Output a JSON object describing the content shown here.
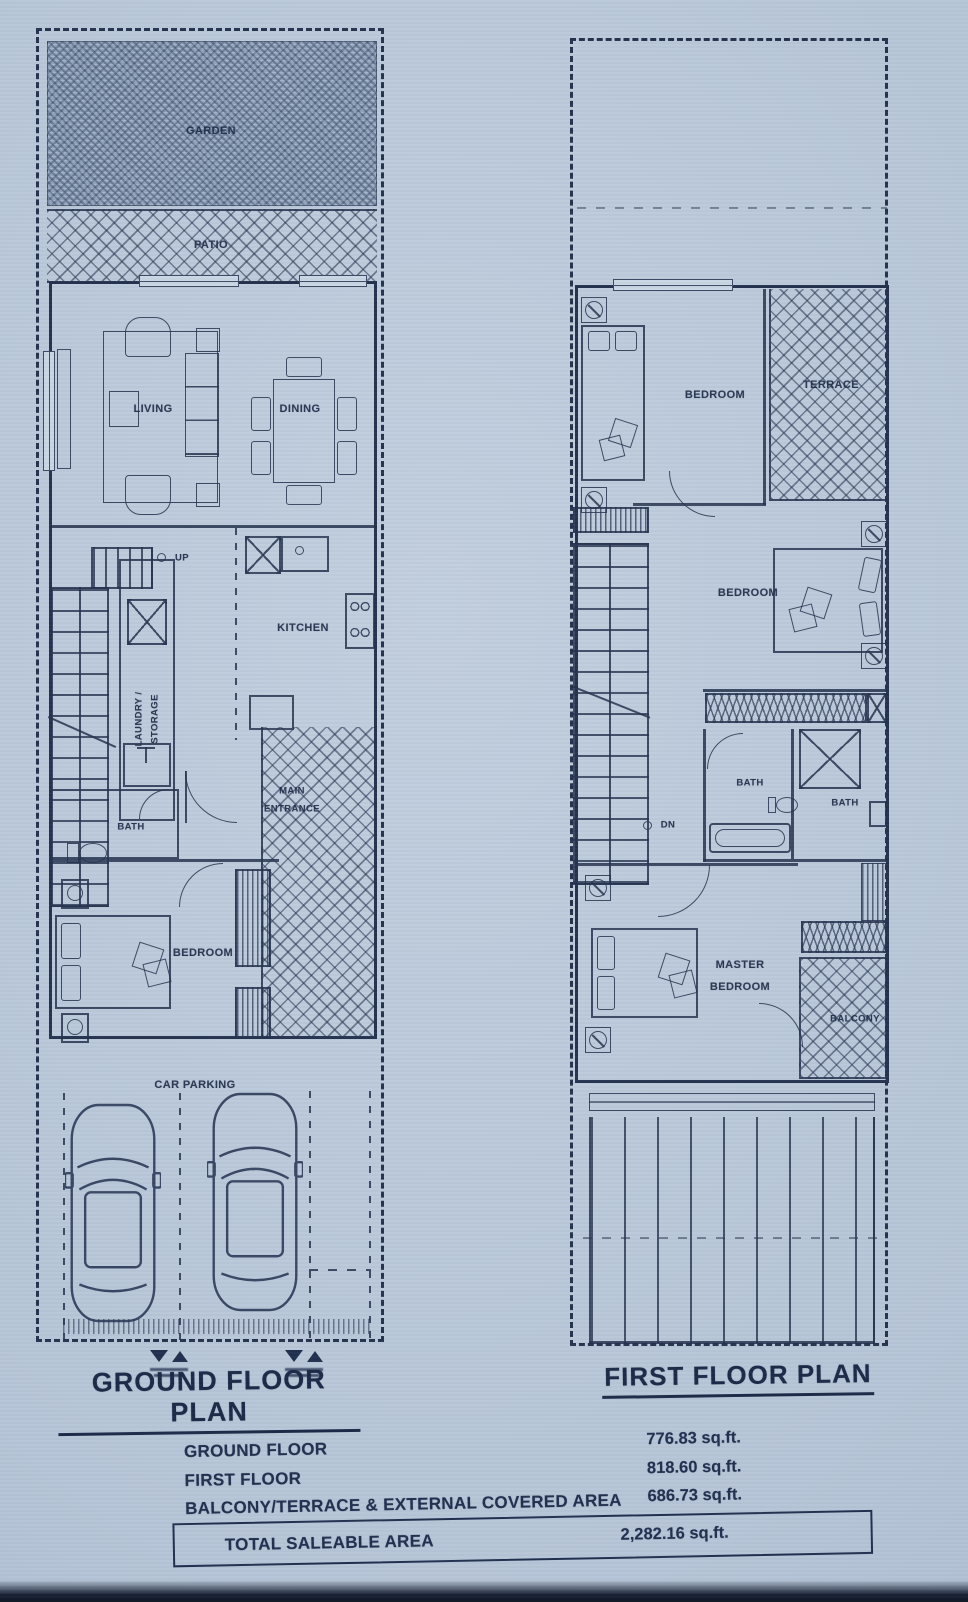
{
  "photo": {
    "paper_color": "#b6c5d7",
    "ink_color": "#26334f"
  },
  "ground_floor": {
    "title": "GROUND FLOOR PLAN",
    "labels": {
      "garden": "GARDEN",
      "patio": "PATIO",
      "living": "LIVING",
      "dining": "DINING",
      "up": "UP",
      "kitchen": "KITCHEN",
      "laundry_line1": "LAUNDRY /",
      "laundry_line2": "STORAGE",
      "bath": "BATH",
      "main_entrance_line1": "MAIN",
      "main_entrance_line2": "ENTRANCE",
      "bedroom": "BEDROOM",
      "car_parking": "CAR PARKING"
    }
  },
  "first_floor": {
    "title": "FIRST FLOOR PLAN",
    "labels": {
      "bedroom_top": "BEDROOM",
      "terrace": "TERRACE",
      "bedroom_mid": "BEDROOM",
      "dn": "DN",
      "bath_left": "BATH",
      "bath_right": "BATH",
      "master_line1": "MASTER",
      "master_line2": "BEDROOM",
      "balcony": "BALCONY"
    }
  },
  "area_summary": {
    "rows": [
      {
        "label": "GROUND FLOOR",
        "value": "776.83 sq.ft."
      },
      {
        "label": "FIRST FLOOR",
        "value": "818.60 sq.ft."
      },
      {
        "label": "BALCONY/TERRACE & EXTERNAL COVERED AREA",
        "value": "686.73 sq.ft."
      }
    ],
    "total": {
      "label": "TOTAL SALEABLE AREA",
      "value": "2,282.16 sq.ft."
    }
  },
  "icons": {
    "stairs_up_marker": "circle + UP text",
    "stairs_dn_marker": "circle + DN text",
    "entry_marker": "double triangle site-entry symbol",
    "car": "top-view car outline",
    "fan_vent": "square with fan circle",
    "washer": "square with X",
    "toilet": "tank + bowl",
    "bathtub": "rounded rectangle tub",
    "stove": "4-burner hob",
    "sink": "basin box"
  }
}
